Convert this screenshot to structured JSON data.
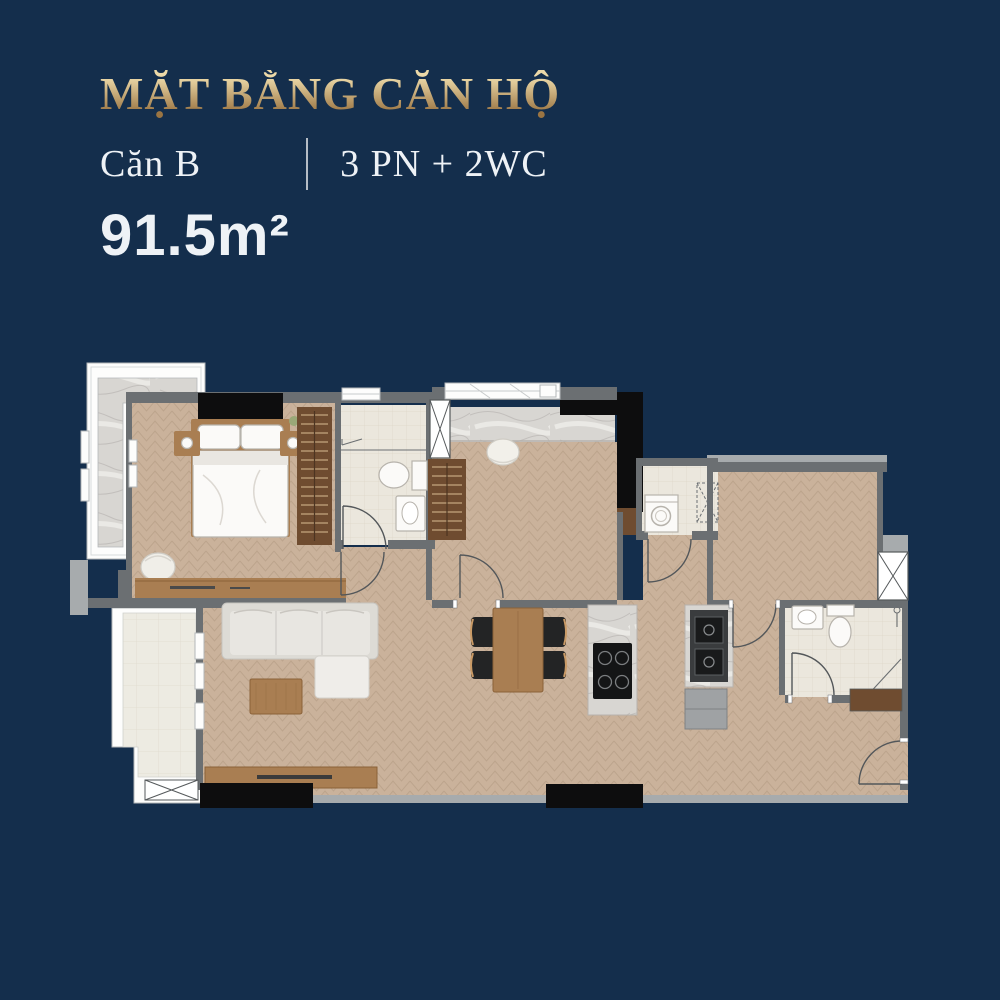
{
  "header": {
    "title": "MẶT BẰNG CĂN HỘ",
    "unit": "Căn B",
    "config": "3 PN + 2WC",
    "area": "91.5m²"
  },
  "colors": {
    "navy": "#142e4c",
    "gold_light": "#ecd9a8",
    "gold_dark": "#9a7442",
    "text_white": "#eef2f6",
    "wall": "#6b6f72",
    "wall_light": "#a7abad",
    "ink": "#0d0d0e",
    "floor": "#cab29b",
    "floor_line": "#b79e86",
    "tile": "#ebe7dd",
    "tile_line": "#ded7c8",
    "btile": "#edebe2",
    "btile_line": "#e0dbce",
    "marble": "#d8d6d2",
    "wood": "#a97e52",
    "wood_deep": "#6f4c30",
    "slat": "#d8bd92"
  }
}
